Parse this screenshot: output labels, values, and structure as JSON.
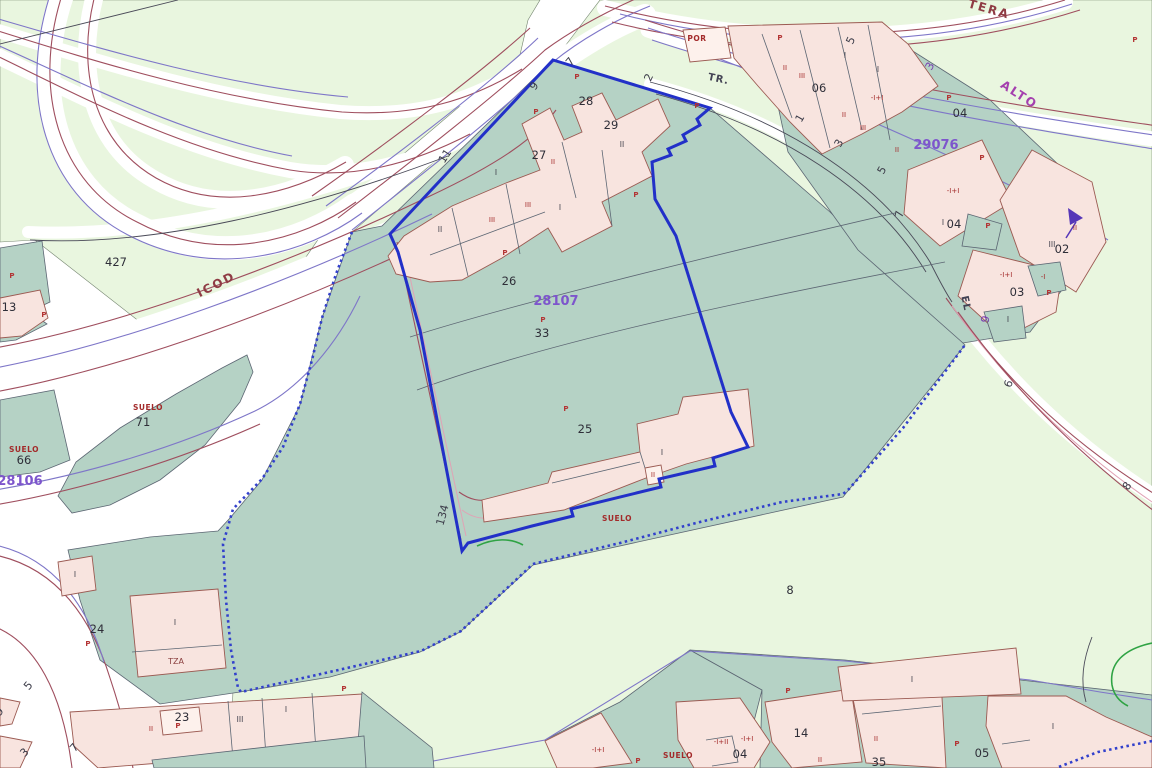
{
  "map_labels": {
    "road_names": [
      {
        "text": "ICOD",
        "x": 218,
        "y": 288,
        "rot": -27,
        "style": "red"
      },
      {
        "text": "TERA",
        "x": 988,
        "y": 13,
        "rot": 16,
        "style": "red"
      },
      {
        "text": "ALTO",
        "x": 1017,
        "y": 98,
        "rot": 33,
        "style": "purple"
      },
      {
        "text": "TR.",
        "x": 718,
        "y": 82,
        "rot": 12,
        "style": "dark"
      },
      {
        "text": "EL",
        "x": 963,
        "y": 304,
        "rot": 78,
        "style": "dark"
      }
    ],
    "parcel_ids": [
      {
        "text": "28107",
        "x": 556,
        "y": 305
      },
      {
        "text": "28106",
        "x": 20,
        "y": 485
      },
      {
        "text": "29076",
        "x": 936,
        "y": 149
      }
    ],
    "parcel_numbers": [
      {
        "text": "427",
        "x": 116,
        "y": 266
      },
      {
        "text": "13",
        "x": 9,
        "y": 311
      },
      {
        "text": "71",
        "x": 143,
        "y": 426
      },
      {
        "text": "66",
        "x": 24,
        "y": 464
      },
      {
        "text": "24",
        "x": 97,
        "y": 633
      },
      {
        "text": "23",
        "x": 182,
        "y": 721
      },
      {
        "text": "26",
        "x": 509,
        "y": 285
      },
      {
        "text": "33",
        "x": 542,
        "y": 337
      },
      {
        "text": "25",
        "x": 585,
        "y": 433
      },
      {
        "text": "27",
        "x": 539,
        "y": 159
      },
      {
        "text": "28",
        "x": 586,
        "y": 105
      },
      {
        "text": "29",
        "x": 611,
        "y": 129
      },
      {
        "text": "06",
        "x": 819,
        "y": 92
      },
      {
        "text": "04",
        "x": 960,
        "y": 117
      },
      {
        "text": "04",
        "x": 954,
        "y": 228
      },
      {
        "text": "02",
        "x": 1062,
        "y": 253
      },
      {
        "text": "03",
        "x": 1017,
        "y": 296
      },
      {
        "text": "05",
        "x": 982,
        "y": 757
      },
      {
        "text": "14",
        "x": 801,
        "y": 737
      },
      {
        "text": "8",
        "x": 790,
        "y": 594
      },
      {
        "text": "04",
        "x": 740,
        "y": 758
      },
      {
        "text": "35",
        "x": 879,
        "y": 766
      }
    ],
    "address_numbers": [
      {
        "text": "11",
        "x": 448,
        "y": 158,
        "rot": -57,
        "style": "dark"
      },
      {
        "text": "9",
        "x": 537,
        "y": 88,
        "rot": -55,
        "style": "dark"
      },
      {
        "text": "7",
        "x": 573,
        "y": 64,
        "rot": -50,
        "style": "dark"
      },
      {
        "text": "2",
        "x": 652,
        "y": 79,
        "rot": -65,
        "style": "dark"
      },
      {
        "text": "1",
        "x": 803,
        "y": 120,
        "rot": -60,
        "style": "dark"
      },
      {
        "text": "3",
        "x": 842,
        "y": 145,
        "rot": -60,
        "style": "dark"
      },
      {
        "text": "5",
        "x": 885,
        "y": 172,
        "rot": -60,
        "style": "dark"
      },
      {
        "text": "5",
        "x": 854,
        "y": 42,
        "rot": -65,
        "style": "dark"
      },
      {
        "text": "7",
        "x": 903,
        "y": 215,
        "rot": -78,
        "style": "dark"
      },
      {
        "text": "6",
        "x": 1012,
        "y": 385,
        "rot": -70,
        "style": "dark"
      },
      {
        "text": "8",
        "x": 1130,
        "y": 488,
        "rot": -55,
        "style": "dark"
      },
      {
        "text": "134",
        "x": 446,
        "y": 516,
        "rot": -75,
        "style": "dark"
      },
      {
        "text": "5",
        "x": 31,
        "y": 688,
        "rot": -50,
        "style": "dark"
      },
      {
        "text": "3",
        "x": 27,
        "y": 755,
        "rot": -45,
        "style": "dark"
      },
      {
        "text": "7",
        "x": 77,
        "y": 750,
        "rot": -48,
        "style": "dark"
      },
      {
        "text": "9",
        "x": 2,
        "y": 714,
        "rot": -50,
        "style": "dark"
      },
      {
        "text": "3",
        "x": 933,
        "y": 68,
        "rot": -60,
        "style": "purple"
      },
      {
        "text": "9",
        "x": 989,
        "y": 320,
        "rot": -78,
        "style": "purple"
      }
    ],
    "zone_labels": [
      {
        "text": "SUELO",
        "x": 148,
        "y": 410,
        "style": "red"
      },
      {
        "text": "SUELO",
        "x": 24,
        "y": 452,
        "style": "red"
      },
      {
        "text": "SUELO",
        "x": 617,
        "y": 521,
        "style": "red"
      },
      {
        "text": "SUELO",
        "x": 678,
        "y": 758,
        "style": "red"
      },
      {
        "text": "POR",
        "x": 697,
        "y": 41,
        "style": "red"
      },
      {
        "text": "TZA",
        "x": 176,
        "y": 664,
        "style": "darkred"
      }
    ],
    "p_markers": [
      [
        536,
        114
      ],
      [
        577,
        79
      ],
      [
        697,
        108
      ],
      [
        636,
        197
      ],
      [
        505,
        255
      ],
      [
        543,
        322
      ],
      [
        566,
        411
      ],
      [
        88,
        646
      ],
      [
        12,
        278
      ],
      [
        44,
        317
      ],
      [
        344,
        691
      ],
      [
        957,
        746
      ],
      [
        788,
        693
      ],
      [
        638,
        763
      ],
      [
        780,
        40
      ],
      [
        949,
        100
      ],
      [
        982,
        160
      ],
      [
        1135,
        42
      ],
      [
        988,
        228
      ],
      [
        1049,
        295
      ],
      [
        178,
        728
      ]
    ],
    "floor_markers": [
      {
        "text": "II",
        "x": 553,
        "y": 164,
        "style": "red"
      },
      {
        "text": "III",
        "x": 528,
        "y": 207,
        "style": "red"
      },
      {
        "text": "III",
        "x": 492,
        "y": 222,
        "style": "red"
      },
      {
        "text": "II",
        "x": 653,
        "y": 477,
        "style": "red"
      },
      {
        "text": "II",
        "x": 844,
        "y": 117,
        "style": "red"
      },
      {
        "text": "III",
        "x": 802,
        "y": 78,
        "style": "red"
      },
      {
        "text": "III",
        "x": 863,
        "y": 130,
        "style": "red"
      },
      {
        "text": "II",
        "x": 897,
        "y": 152,
        "style": "red"
      },
      {
        "text": "II",
        "x": 785,
        "y": 70,
        "style": "red"
      },
      {
        "text": "-I+I",
        "x": 877,
        "y": 100,
        "style": "red"
      },
      {
        "text": "-I+I",
        "x": 953,
        "y": 193,
        "style": "red"
      },
      {
        "text": "-I+I",
        "x": 1006,
        "y": 277,
        "style": "red"
      },
      {
        "text": "-I",
        "x": 1043,
        "y": 279,
        "style": "red"
      },
      {
        "text": "II",
        "x": 1075,
        "y": 230,
        "style": "red"
      },
      {
        "text": "-I+I",
        "x": 598,
        "y": 752,
        "style": "red"
      },
      {
        "text": "-I+II",
        "x": 721,
        "y": 744,
        "style": "red"
      },
      {
        "text": "-I+I",
        "x": 747,
        "y": 741,
        "style": "red"
      },
      {
        "text": "II",
        "x": 820,
        "y": 762,
        "style": "red"
      },
      {
        "text": "II",
        "x": 876,
        "y": 741,
        "style": "red"
      },
      {
        "text": "II",
        "x": 151,
        "y": 731,
        "style": "red"
      },
      {
        "text": "II",
        "x": 440,
        "y": 232,
        "style": "dark"
      },
      {
        "text": "I",
        "x": 496,
        "y": 175,
        "style": "dark"
      },
      {
        "text": "I",
        "x": 560,
        "y": 210,
        "style": "dark"
      },
      {
        "text": "II",
        "x": 622,
        "y": 147,
        "style": "dark"
      },
      {
        "text": "I",
        "x": 75,
        "y": 577,
        "style": "dark"
      },
      {
        "text": "I",
        "x": 175,
        "y": 625,
        "style": "dark"
      },
      {
        "text": "I",
        "x": 662,
        "y": 455,
        "style": "dark"
      },
      {
        "text": "I",
        "x": 912,
        "y": 682,
        "style": "dark"
      },
      {
        "text": "I",
        "x": 1053,
        "y": 729,
        "style": "dark"
      },
      {
        "text": "I",
        "x": 286,
        "y": 712,
        "style": "dark"
      },
      {
        "text": "III",
        "x": 240,
        "y": 722,
        "style": "dark"
      },
      {
        "text": "I",
        "x": 845,
        "y": 58,
        "style": "dark"
      },
      {
        "text": "I",
        "x": 878,
        "y": 72,
        "style": "dark"
      },
      {
        "text": "III",
        "x": 1052,
        "y": 247,
        "style": "dark"
      },
      {
        "text": "I",
        "x": 943,
        "y": 225,
        "style": "dark"
      },
      {
        "text": "I",
        "x": 1008,
        "y": 322,
        "style": "dark"
      }
    ],
    "colors": {
      "rural_land": "#e9f6df",
      "urban_land": "#b5d2c5",
      "building": "#f8e4df",
      "building_outline": "#9b5a52",
      "selection_blue": "#2230c8",
      "road_maroon": "#9f4e5e",
      "road_purple": "#7e76c8",
      "parcel_id_purple": "#7d55cc",
      "label_red": "#a32a2a"
    }
  }
}
